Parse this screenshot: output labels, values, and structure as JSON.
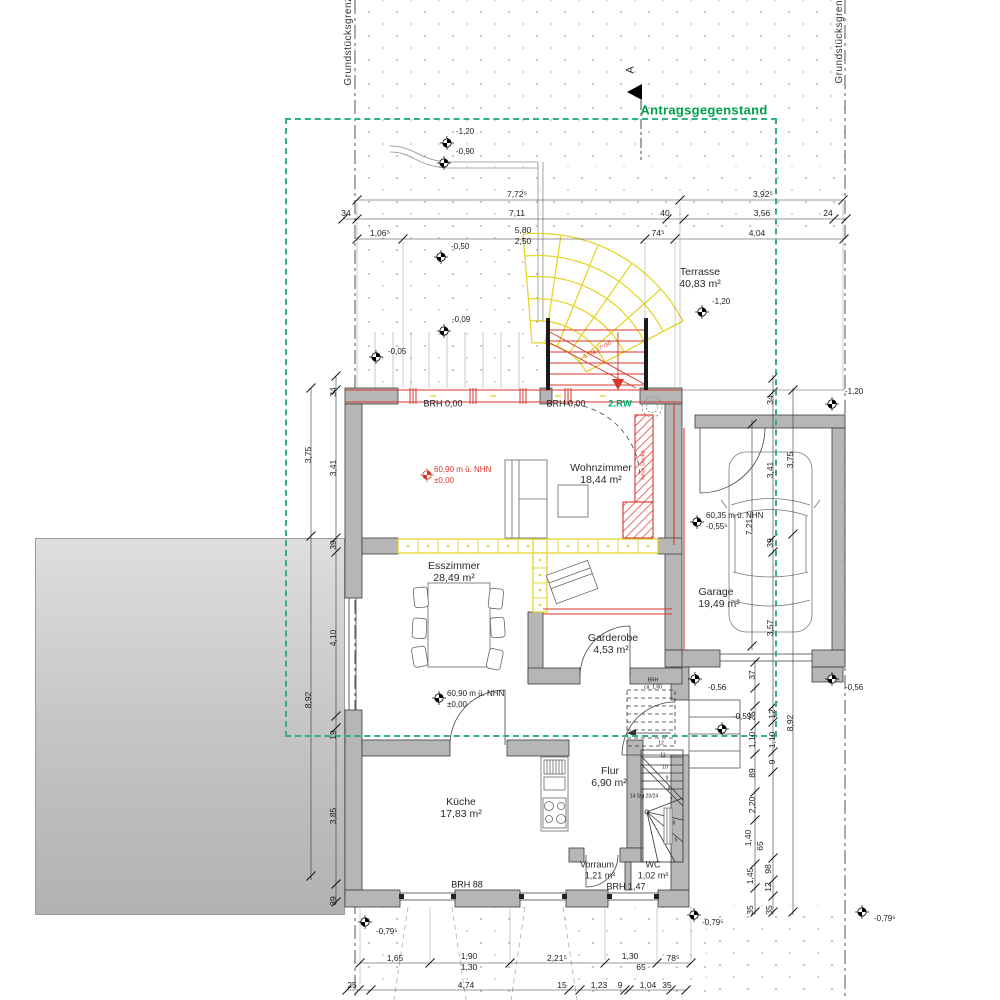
{
  "title": {
    "label": "Antragsgegenstand",
    "section": "A"
  },
  "boundary": {
    "left": "Grundstücksgrenze",
    "right": "Grundstücksgrenze"
  },
  "colors": {
    "new_red": "#d6372b",
    "demolition_yellow": "#e6d722",
    "application_green": "#2fb183",
    "wall_gray": "#b6b6b6"
  },
  "rooms": {
    "terrasse": {
      "name": "Terrasse",
      "area": "40,83 m²"
    },
    "wohnzimmer": {
      "name": "Wohnzimmer",
      "area": "18,44 m²"
    },
    "esszimmer": {
      "name": "Esszimmer",
      "area": "28,49 m²"
    },
    "garderobe": {
      "name": "Garderobe",
      "area": "4,53 m²"
    },
    "kueche": {
      "name": "Küche",
      "area": "17,83 m²"
    },
    "flur": {
      "name": "Flur",
      "area": "6,90 m²"
    },
    "vorraum": {
      "name": "Vorraum",
      "area": "1,21 m²"
    },
    "wc": {
      "name": "WC",
      "area": "1,02 m²"
    },
    "garage": {
      "name": "Garage",
      "area": "19,49 m²"
    }
  },
  "heights": {
    "wz1": "60,90 m ü. NHN",
    "wz2": "±0,00",
    "ez1": "60,90 m ü. NHN",
    "ez2": "±0,00",
    "ga1": "60,35 m ü. NHN",
    "ga2": "-0,55⁵"
  },
  "points": {
    "p1": "-1,20",
    "p2": "-0,90",
    "p3": "-0,50",
    "p4": "-0,09",
    "p5": "-0,05",
    "p6": "-1,20",
    "p7": "-1,20",
    "p8": "-0,56",
    "p9": "-0,56",
    "p10": "-0,59⁵",
    "p11": "-0,79⁵",
    "p12": "-0,79⁵",
    "p13": "-0,79⁵"
  },
  "brh": {
    "b1": "BRH 0,00",
    "b2": "BRH 0,00",
    "rw": "2.RW",
    "b3": "BRH 88",
    "b4": "BRH 1,47",
    "b5": "BRH",
    "b5b": "ca. 1,60"
  },
  "stair": {
    "ext": "5 Stg 17⁵/30",
    "int": "14 Stg 20/24",
    "n": [
      "12",
      "11",
      "10",
      "9",
      "8",
      "7",
      "6",
      "5"
    ]
  },
  "new_label": "neue Decke",
  "dims": {
    "t1": [
      "7,72⁵",
      "3,92⁵"
    ],
    "t2": [
      "34",
      "7,11",
      "40",
      "3,56",
      "24"
    ],
    "t3": [
      "1,06⁵",
      "5,80",
      "2,50",
      "74⁵",
      "4,04"
    ],
    "b1": [
      "1,65",
      "1,90",
      "1,30",
      "2,21⁵",
      "1,30",
      "65",
      "78⁵"
    ],
    "b2": [
      "25",
      "4,74",
      "15",
      "1,23",
      "9",
      "1,04",
      "35"
    ],
    "lo": [
      "3,75",
      "8,92"
    ],
    "li": [
      "34",
      "3,41",
      "39",
      "4,10",
      "19",
      "3,85",
      "39"
    ],
    "ra": [
      "7,21",
      "37",
      "25",
      "1,10",
      "89",
      "2,20",
      "1,40",
      "65",
      "1,45",
      "35"
    ],
    "rb": [
      "34",
      "3,41",
      "39",
      "3,57",
      "12",
      "1,10",
      "9",
      "98",
      "12",
      "35"
    ],
    "rc": [
      "3,75",
      "8,92"
    ]
  }
}
